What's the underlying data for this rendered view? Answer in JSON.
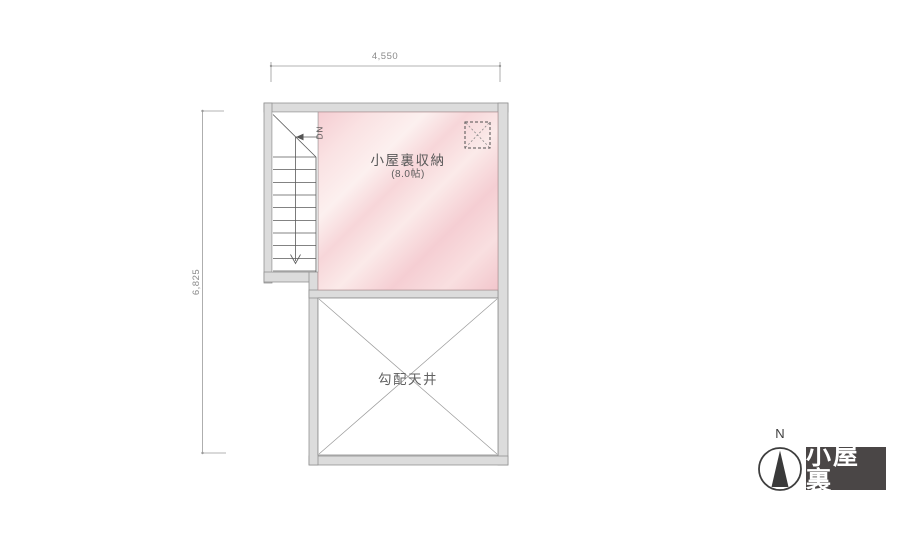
{
  "title": "小屋裏 平面図",
  "plan": {
    "dimensions": {
      "width_label": "4,550",
      "height_label": "6,825"
    },
    "rooms": {
      "storage": {
        "label": "小屋裏収納",
        "size": "(8.0帖)"
      },
      "sloped_ceiling": {
        "label": "勾配天井"
      }
    },
    "stairs": {
      "direction_label": "DN",
      "step_count": 10
    },
    "icons": {
      "hatch": "attic-hatch-dashed-square"
    }
  },
  "compass": {
    "north_label": "N"
  },
  "floor_badge": {
    "label": "小屋裏"
  },
  "colors": {
    "background": "#ffffff",
    "wall_fill": "#dcdcdc",
    "wall_line": "#8d8d8d",
    "room_pink_dark": "#f2c6cc",
    "room_pink_light": "#fcf0ef",
    "plan_line": "#6f6f6f",
    "dimension_line": "#9a9a9a",
    "dimension_text": "#8a8a8a",
    "label_text": "#585858",
    "badge_bg": "#4a4646",
    "badge_text": "#ffffff",
    "compass_dark": "#3a3a3a"
  }
}
